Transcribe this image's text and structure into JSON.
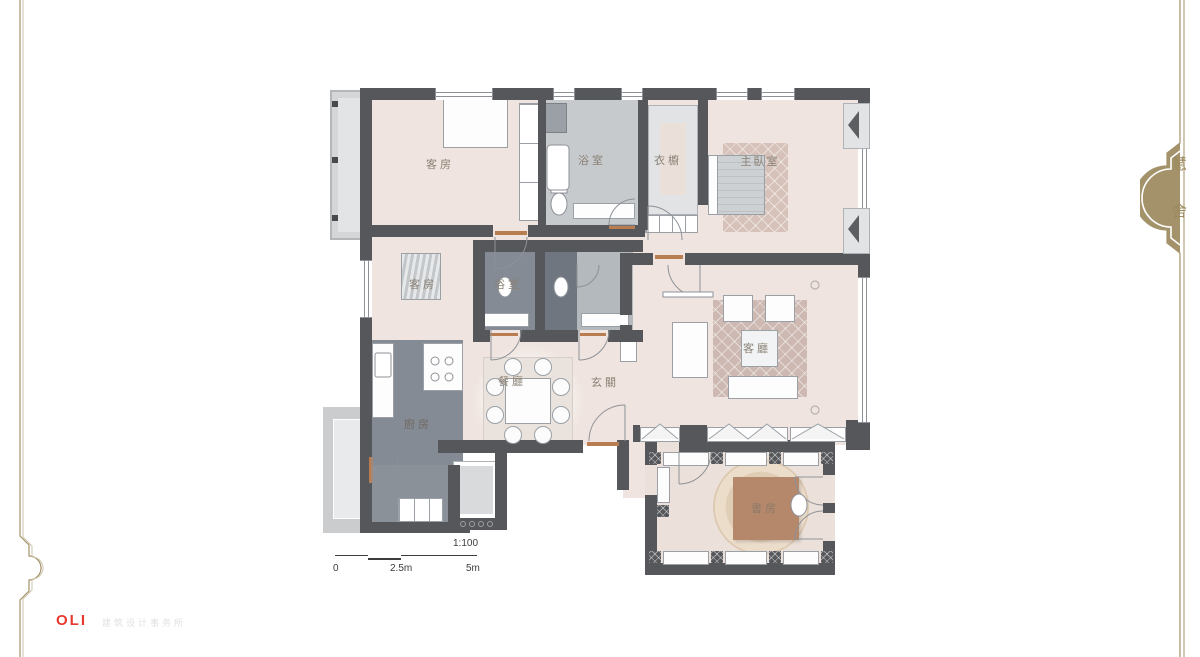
{
  "floorplan": {
    "rooms": [
      {
        "id": "guest-room-1",
        "label": "客房"
      },
      {
        "id": "bathroom-1",
        "label": "浴室"
      },
      {
        "id": "wardrobe",
        "label": "衣櫥"
      },
      {
        "id": "master-bedroom",
        "label": "主臥室"
      },
      {
        "id": "guest-room-2",
        "label": "客房"
      },
      {
        "id": "bathroom-2",
        "label": "浴室"
      },
      {
        "id": "living-room",
        "label": "客廳"
      },
      {
        "id": "dining-room",
        "label": "餐廳"
      },
      {
        "id": "foyer",
        "label": "玄關"
      },
      {
        "id": "kitchen",
        "label": "廚房"
      },
      {
        "id": "study",
        "label": "書房"
      }
    ],
    "scale_bar": {
      "ratio": "1:100",
      "tick_start": "0",
      "tick_mid": "2.5m",
      "tick_end": "5m"
    }
  },
  "brand": {
    "name": "OLI",
    "subtitle": "建筑设计事务所"
  },
  "side_mark": {
    "top": "慧",
    "bottom": "舍"
  },
  "colors": {
    "wall": "#56575b",
    "floor": "#efe4df",
    "wet_dark": "#848b94",
    "wet_mid": "#a7adb3",
    "wet_light": "#c6cacd",
    "balcony": "#d5d6d8",
    "rug_pink": "#d6c2b9",
    "rug_cream": "#e8d8c4",
    "wood": "#b5886b",
    "logo_red": "#e8392e",
    "ornament": "#a3926a",
    "label": "#8a8175"
  }
}
